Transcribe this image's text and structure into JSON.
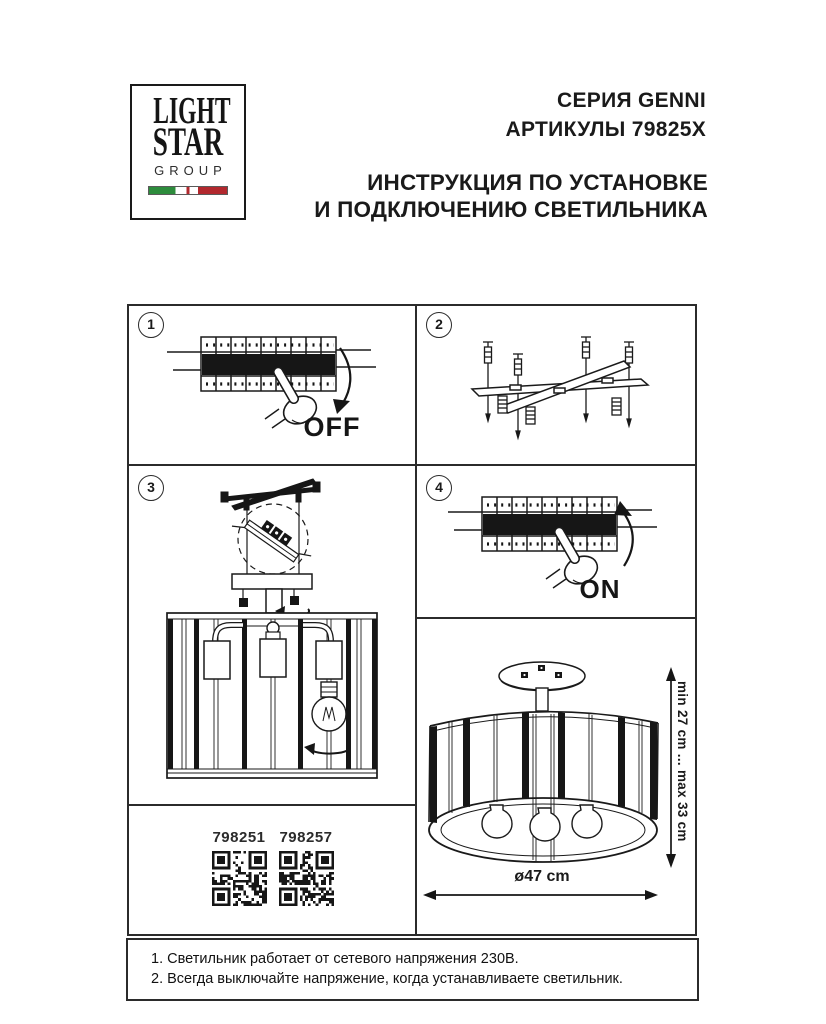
{
  "header": {
    "logo": {
      "line1": "LIGHT",
      "line2": "STAR",
      "line3": "GROUP"
    },
    "series": "СЕРИЯ GENNI",
    "articles": "АРТИКУЛЫ 79825X",
    "instr1": "ИНСТРУКЦИЯ ПО УСТАНОВКЕ",
    "instr2": "И ПОДКЛЮЧЕНИЮ СВЕТИЛЬНИКА"
  },
  "steps": {
    "s1": {
      "num": "1",
      "label": "OFF"
    },
    "s2": {
      "num": "2"
    },
    "s3": {
      "num": "3"
    },
    "s4": {
      "num": "4",
      "label": "ON"
    }
  },
  "qr": {
    "left": "798251",
    "right": "798257"
  },
  "dims": {
    "height": "min 27 cm ... max 33 cm",
    "diameter": "ø47 cm"
  },
  "notes": {
    "n1": "1. Светильник работает от сетевого напряжения 230В.",
    "n2": "2. Всегда выключайте напряжение, когда устанавливаете светильник."
  },
  "colors": {
    "flag_green": "#2d8c3c",
    "flag_red": "#b2282e",
    "ink": "#1a1a1a"
  }
}
